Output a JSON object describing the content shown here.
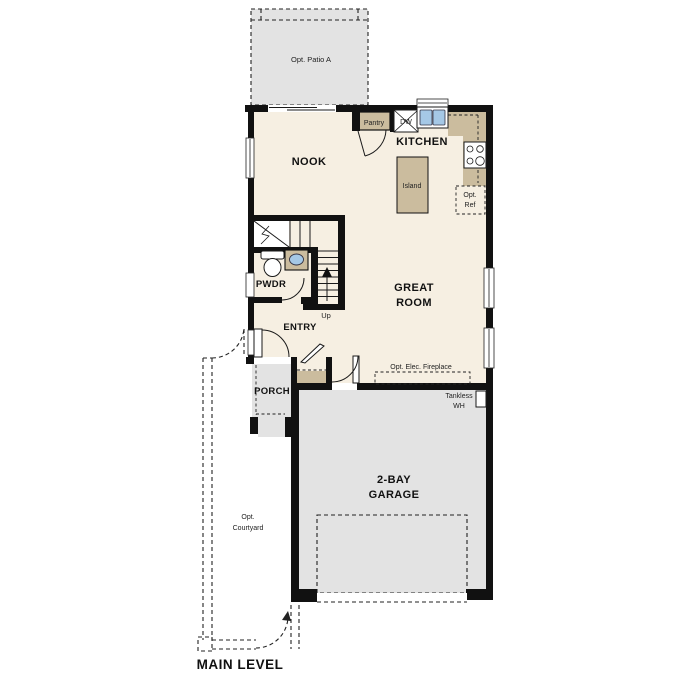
{
  "plan": {
    "level_title": "MAIN LEVEL",
    "rooms": {
      "nook": "NOOK",
      "kitchen": "KITCHEN",
      "great_room": {
        "line1": "GREAT",
        "line2": "ROOM"
      },
      "entry": "ENTRY",
      "pwdr": "PWDR",
      "porch": "PORCH",
      "garage": {
        "line1": "2-BAY",
        "line2": "GARAGE"
      }
    },
    "labels": {
      "patio": "Opt. Patio A",
      "courtyard": {
        "line1": "Opt.",
        "line2": "Courtyard"
      },
      "pantry": "Pantry",
      "dishwasher": "DW",
      "island": "Island",
      "ref": {
        "line1": "Opt.",
        "line2": "Ref"
      },
      "up": "Up",
      "tankless": {
        "line1": "Tankless",
        "line2": "WH"
      },
      "fireplace": "Opt. Elec. Fireplace"
    },
    "colors": {
      "background": "#ffffff",
      "interior": "#f6efe2",
      "tan": "#cbbc9e",
      "gray": "#e3e3e3",
      "wall": "#111111",
      "blue": "#a5c8e6"
    }
  }
}
